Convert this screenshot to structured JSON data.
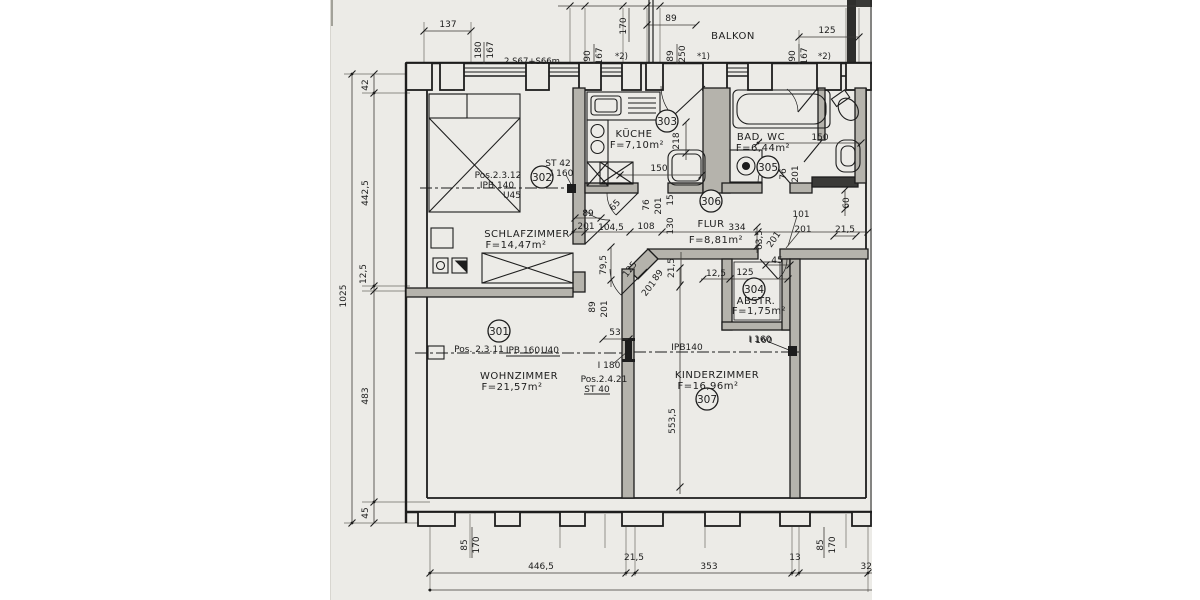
{
  "drawing_note": "2 S67+S66m",
  "rooms": {
    "balkon": {
      "name": "BALKON"
    },
    "schlafzimmer": {
      "name": "SCHLAFZIMMER",
      "area": "F=14,47m²",
      "nr": "302",
      "pos": "Pos.2.3.12",
      "beam": "IPB 140",
      "u": "U45",
      "st": "ST 42",
      "i": "I 160"
    },
    "kueche": {
      "name": "KÜCHE",
      "area": "F=7,10m²",
      "nr": "303"
    },
    "bad": {
      "name": "BAD, WC",
      "area": "F=6,44m²",
      "nr": "305"
    },
    "flur": {
      "name": "FLUR",
      "area": "F=8,81m²",
      "nr": "306"
    },
    "abstellraum": {
      "name": "ABSTR.",
      "area": "F=1,75m²",
      "nr": "304",
      "lintel": "I 160"
    },
    "wohnzimmer": {
      "name": "WOHNZIMMER",
      "area": "F=21,57m²",
      "nr": "301",
      "pos": "Pos. 2.3.11",
      "beam": "IPB 160",
      "u": "U40"
    },
    "kinderzimmer": {
      "name": "KINDERZIMMER",
      "area": "F=16,96m²",
      "nr": "307",
      "beam": "IPB140",
      "lintel": "I 160"
    },
    "tuersturz": {
      "i": "I 180",
      "pos": "Pos.2.4.21",
      "st": "ST 40"
    }
  },
  "labels": {
    "l1025": "1025",
    "l42": "42",
    "l4425": "442,5",
    "l125": "12,5",
    "l483": "483",
    "l45": "45",
    "t137": "137",
    "t180": "180",
    "t167": "167",
    "t170": "170",
    "t89": "89",
    "t125": "125",
    "g90a": "90",
    "g167a": "167",
    "n2a": "*2)",
    "g89": "89",
    "g250": "250",
    "n1": "*1)",
    "g90b": "90",
    "g167b": "167",
    "n2b": "*2)",
    "b85a": "85",
    "b170a": "170",
    "b4465": "446,5",
    "b215": "21,5",
    "b353": "353",
    "b13": "13",
    "b32": "32",
    "b85b": "85",
    "b170b": "170",
    "f89": "89",
    "f201": "201",
    "f1045": "104,5",
    "f108": "108",
    "f130": "130",
    "f334": "334",
    "f635": "63,5",
    "f201d": "201",
    "f101": "101",
    "f201b": "201",
    "f215": "21,5",
    "f60": "60",
    "f45": "45",
    "ab125": "12,5",
    "ab125b": "125",
    "c125": "125",
    "c89": "89",
    "c201": "201",
    "c215": "21,5",
    "c795": "79,5",
    "c65": "65",
    "w89": "89",
    "w201": "201",
    "w53": "53",
    "k218": "218",
    "k150": "150",
    "k76": "76",
    "k201": "201",
    "k15": "15",
    "ba150": "150",
    "ba76": "76",
    "ba201": "201",
    "ki5535": "553,5"
  }
}
